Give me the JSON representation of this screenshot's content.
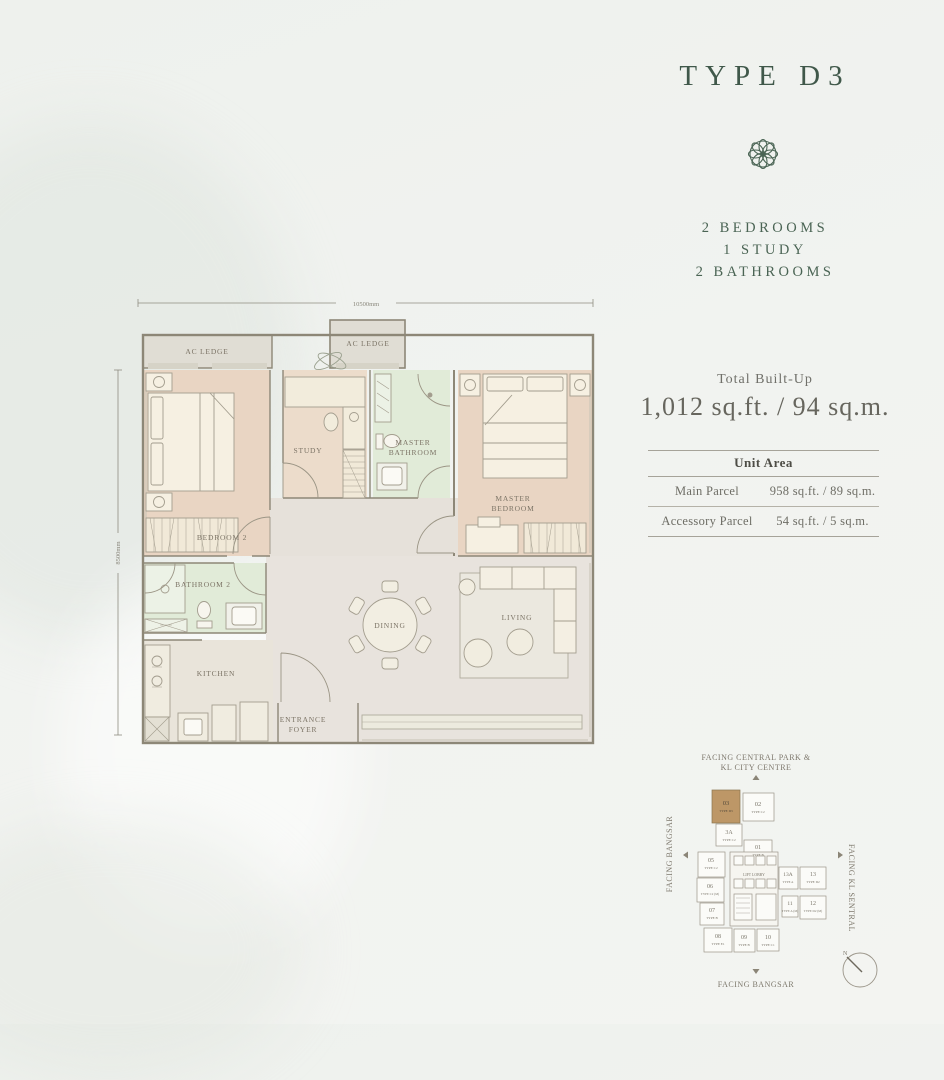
{
  "header": {
    "title": "TYPE D3",
    "features": [
      "2 BEDROOMS",
      "1 STUDY",
      "2 BATHROOMS"
    ]
  },
  "builtup": {
    "label": "Total Built-Up",
    "value": "1,012 sq.ft. / 94 sq.m."
  },
  "unit_area": {
    "header": "Unit Area",
    "rows": [
      {
        "label": "Main Parcel",
        "value": "958 sq.ft. / 89 sq.m."
      },
      {
        "label": "Accessory Parcel",
        "value": "54 sq.ft. / 5 sq.m."
      }
    ]
  },
  "floorplan": {
    "dim_width": "10500mm",
    "dim_height": "8500mm",
    "rooms": {
      "ac_ledge": "AC LEDGE",
      "bedroom2": "BEDROOM 2",
      "study": "STUDY",
      "master_bath_l1": "MASTER",
      "master_bath_l2": "BATHROOM",
      "master_bed_l1": "MASTER",
      "master_bed_l2": "BEDROOM",
      "bathroom2": "BATHROOM 2",
      "kitchen": "KITCHEN",
      "dining": "DINING",
      "living": "LIVING",
      "foyer_l1": "ENTRANCE",
      "foyer_l2": "FOYER"
    }
  },
  "keyplan": {
    "facing_top_l1": "FACING CENTRAL PARK &",
    "facing_top_l2": "KL CITY CENTRE",
    "facing_left": "FACING BANGSAR",
    "facing_right": "FACING KL SENTRAL",
    "facing_bottom": "FACING BANGSAR",
    "lift_lobby": "LIFT LOBBY",
    "compass_n": "N",
    "units": [
      {
        "no": "03",
        "type": "TYPE D3",
        "highlight": true
      },
      {
        "no": "02",
        "type": "TYPE C2"
      },
      {
        "no": "3A",
        "type": "TYPE C2"
      },
      {
        "no": "01",
        "type": "TYPE B"
      },
      {
        "no": "05",
        "type": "TYPE C2"
      },
      {
        "no": "06",
        "type": "TYPE C2 (M)"
      },
      {
        "no": "07",
        "type": "TYPE B"
      },
      {
        "no": "08",
        "type": "TYPE E1"
      },
      {
        "no": "09",
        "type": "TYPE B"
      },
      {
        "no": "10",
        "type": "TYPE C1"
      },
      {
        "no": "13A",
        "type": "TYPE A"
      },
      {
        "no": "13",
        "type": "TYPE D2"
      },
      {
        "no": "11",
        "type": "TYPE A (M)"
      },
      {
        "no": "12",
        "type": "TYPE D2 (M)"
      }
    ]
  },
  "colors": {
    "accent_green": "#44604f",
    "highlight_brown": "#bd9767",
    "bedroom_fill": "#e9d5c3",
    "bathroom_fill": "#e1ebd8",
    "floor_fill": "#e8e3dd",
    "ac_ledge_fill": "#e0ddd4"
  }
}
